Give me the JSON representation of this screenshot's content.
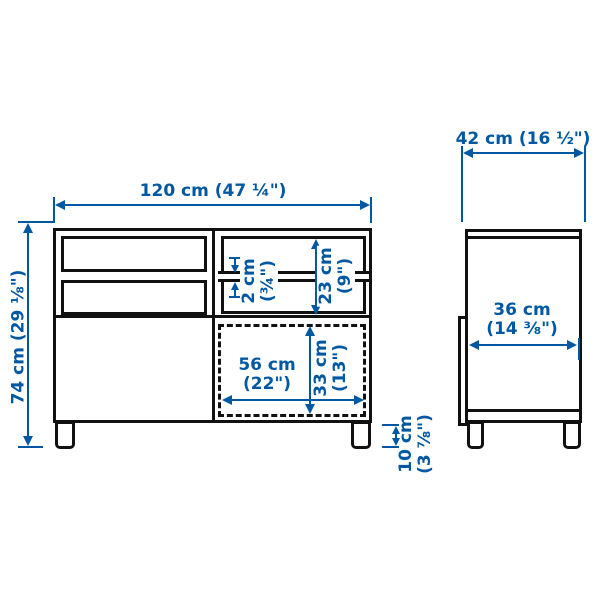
{
  "colors": {
    "dimension_blue": "#0058A3",
    "drawing_black": "#111111",
    "background": "#ffffff"
  },
  "front_view": {
    "overall_width": "120 cm (47 ¼\")",
    "overall_height": "74 cm (29 ⅛\")",
    "shelf_thickness": [
      "2 cm",
      "(¾\")"
    ],
    "open_compartment_height": [
      "23 cm",
      "(9\")"
    ],
    "door_width": [
      "56 cm",
      "(22\")"
    ],
    "door_height": [
      "33 cm",
      "(13\")"
    ],
    "leg_height": [
      "10 cm",
      "(3 ⅞\")"
    ]
  },
  "side_view": {
    "overall_depth": "42 cm (16 ½\")",
    "inner_depth": [
      "36 cm",
      "(14 ⅜\")"
    ]
  }
}
